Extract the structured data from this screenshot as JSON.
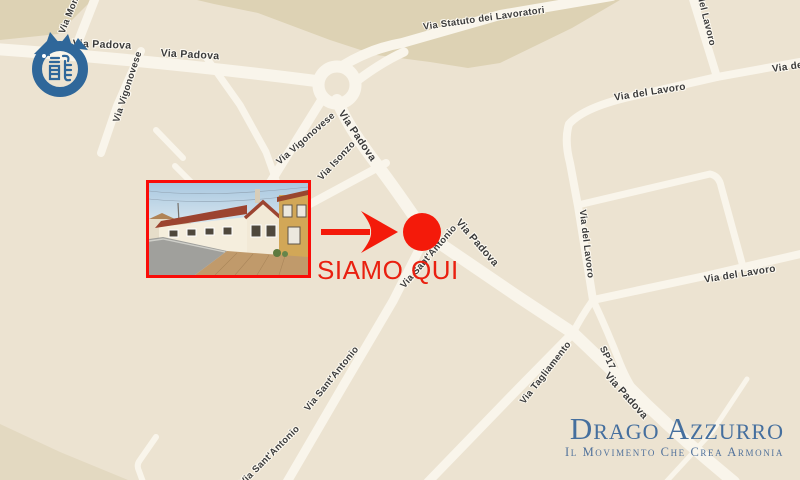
{
  "brand": {
    "title": "Drago Azzurro",
    "subtitle": "Il Movimento Che Crea Armonia",
    "title_color": "#456f9e"
  },
  "annotation": {
    "label": "SIAMO QUI",
    "marker_color": "#f41a0a",
    "text_color": "#e92010",
    "photo_border_color": "#fa0c08"
  },
  "icons": {
    "dragon_logo": "blue-enso-dragon-circle-with-kanji",
    "location_marker": "red-dot",
    "pointer_arrow": "red-right-arrow"
  },
  "map": {
    "background_color": "#ece3d1",
    "district_shade_color": "#ddd2b4",
    "road_color": "#f9f5eb",
    "labels": [
      {
        "text": "Via Padova"
      },
      {
        "text": "Via Padova"
      },
      {
        "text": "Via Statuto dei Lavoratori"
      },
      {
        "text": "Via Mont"
      },
      {
        "text": "Via Vigonovese"
      },
      {
        "text": "Via Vigonovese"
      },
      {
        "text": "Via Isonzo"
      },
      {
        "text": "Via Padova"
      },
      {
        "text": "Via Padova"
      },
      {
        "text": "Via Sant'Antonio"
      },
      {
        "text": "Via Sant'Antonio"
      },
      {
        "text": "Via Sant'Antonio"
      },
      {
        "text": "Via Tagliamento"
      },
      {
        "text": "SP17"
      },
      {
        "text": "Via Padova"
      },
      {
        "text": "del Lavoro"
      },
      {
        "text": "Via del Lavoro"
      },
      {
        "text": "Via del Lavoro"
      },
      {
        "text": "Via del Lavoro"
      },
      {
        "text": "Via del Lavoro"
      }
    ]
  }
}
